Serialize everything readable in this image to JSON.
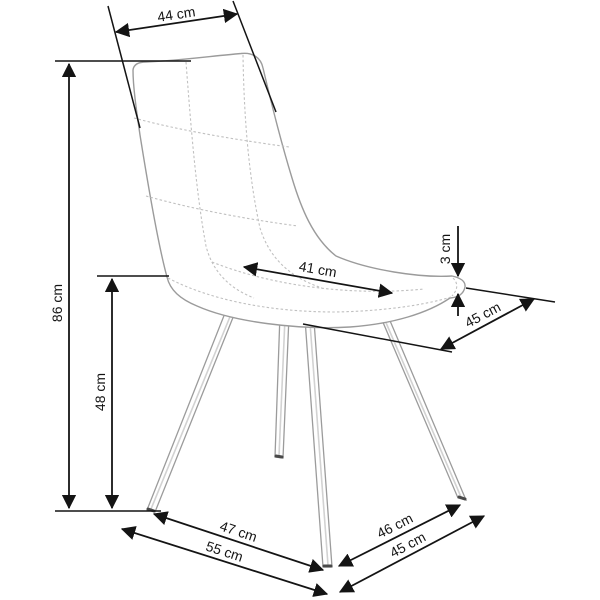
{
  "diagram": {
    "type": "furniture-dimension-diagram",
    "subject": "quilted upholstered chair on four splayed metal legs, three-quarter view",
    "unit": "cm",
    "dims": {
      "backrest_width": {
        "label": "44 cm",
        "value": 44
      },
      "overall_height": {
        "label": "86 cm",
        "value": 86
      },
      "seat_height": {
        "label": "48 cm",
        "value": 48
      },
      "seat_depth": {
        "label": "41 cm",
        "value": 41
      },
      "seat_edge_thickness": {
        "label": "3 cm",
        "value": 3
      },
      "seat_width": {
        "label": "45 cm",
        "value": 45
      },
      "leg_span_side": {
        "label": "47 cm",
        "value": 47
      },
      "base_depth": {
        "label": "55 cm",
        "value": 55
      },
      "leg_span_front": {
        "label": "46 cm",
        "value": 46
      },
      "base_width": {
        "label": "45 cm",
        "value": 45
      }
    },
    "colors": {
      "dimension_line": "#141414",
      "label_text": "#141414",
      "chair_outline": "#9b9b9b",
      "chair_fill": "#ffffff",
      "fabric_texture_dot": "#c9c9c9",
      "background": "#ffffff"
    }
  }
}
